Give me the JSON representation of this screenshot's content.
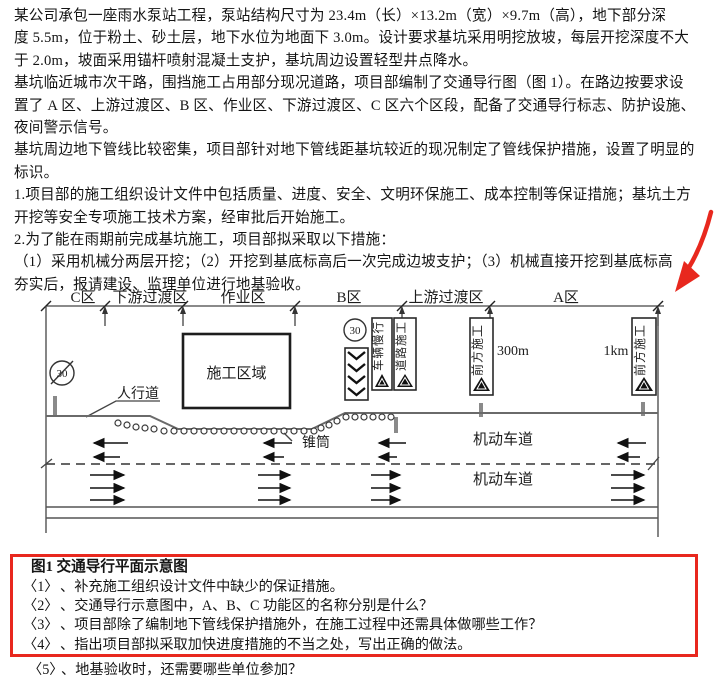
{
  "document": {
    "body_lines": [
      "某公司承包一座雨水泵站工程，泵站结构尺寸为 23.4m（长）×13.2m（宽）×9.7m（高），地下部分深",
      "度 5.5m，位于粉土、砂土层，地下水位为地面下 3.0m。设计要求基坑采用明挖放坡，每层开挖深度不大",
      "于 2.0m，坡面采用锚杆喷射混凝土支护，基坑周边设置轻型井点降水。",
      "基坑临近城市次干路，围挡施工占用部分现况道路，项目部编制了交通导行图（图 1）。在路边按要求设",
      "置了 A 区、上游过渡区、B 区、作业区、下游过渡区、C 区六个区段，配备了交通导行标志、防护设施、",
      "夜间警示信号。",
      "基坑周边地下管线比较密集，项目部针对地下管线距基坑较近的现况制定了管线保护措施，设置了明显的",
      "标识。",
      "1.项目部的施工组织设计文件中包括质量、进度、安全、文明环保施工、成本控制等保证措施；基坑土方",
      "开挖等安全专项施工技术方案，经审批后开始施工。",
      "2.为了能在雨期前完成基坑施工，项目部拟采取以下措施：",
      "（1）采用机械分两层开挖；（2）开挖到基底标高后一次完成边坡支护；（3）机械直接开挖到基底标高",
      "夯实后，报请建设、监理单位进行地基验收。"
    ]
  },
  "diagram": {
    "zones": [
      "C区",
      "下游过渡区",
      "作业区",
      "B区",
      "上游过渡区",
      "A区"
    ],
    "signs": {
      "speed_limit_end": "30",
      "speed_limit": "30",
      "slow_vehicles": "车辆慢行",
      "road_construction": "道路施工",
      "construction_ahead_300m": "前方施工",
      "construction_ahead_1km": "前方施工"
    },
    "labels": {
      "construction_area": "施工区域",
      "sidewalk": "人行道",
      "cones": "锥筒",
      "motor_lane_upper": "机动车道",
      "motor_lane_lower": "机动车道",
      "distance_300m": "300m",
      "distance_1km": "1km"
    }
  },
  "figure_box": {
    "title": "图1 交通导行平面示意图",
    "questions": [
      {
        "num": "〈1〉",
        "text": "、补充施工组织设计文件中缺少的保证措施。"
      },
      {
        "num": "〈2〉",
        "text": "、交通导行示意图中，A、B、C 功能区的名称分别是什么？"
      },
      {
        "num": "〈3〉",
        "text": "、项目部除了编制地下管线保护措施外，在施工过程中还需具体做哪些工作？"
      },
      {
        "num": "〈4〉",
        "text": "、指出项目部拟采取加快进度措施的不当之处，写出正确的做法。"
      }
    ],
    "clipped_question": {
      "num": "〈5〉",
      "text": "、地基验收时，还需要哪些单位参加？"
    }
  },
  "colors": {
    "accent_red": "#e8281e",
    "diagram_grey": "#6a6a6a",
    "text": "#141414"
  }
}
